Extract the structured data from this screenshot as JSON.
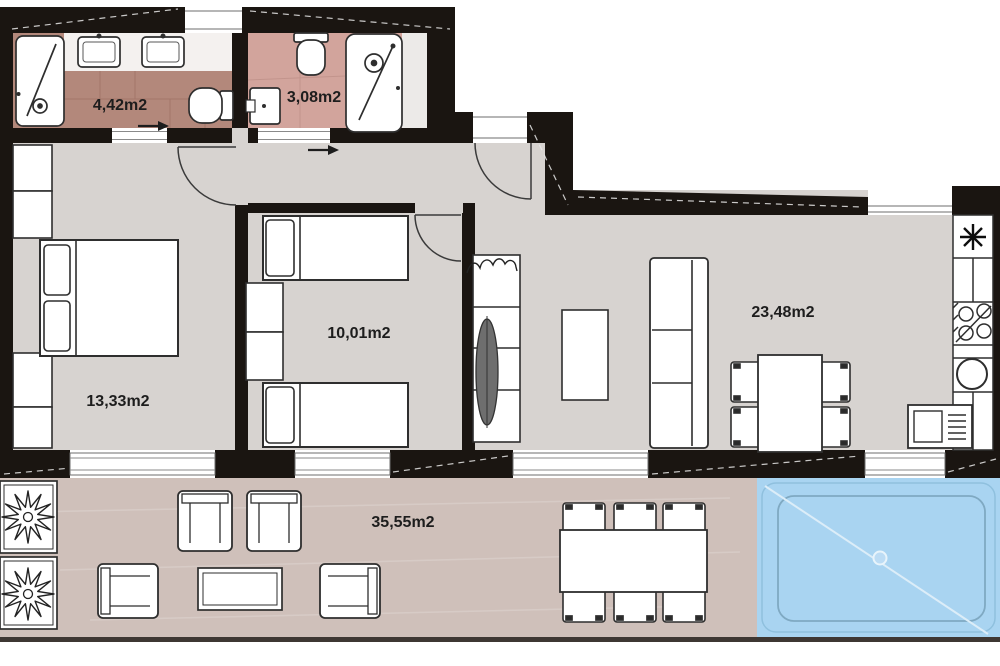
{
  "rooms": {
    "bathroom1": {
      "area": "4,42m2"
    },
    "bathroom2": {
      "area": "3,08m2"
    },
    "bedroom1": {
      "area": "13,33m2"
    },
    "bedroom2": {
      "area": "10,01m2"
    },
    "living_kitchen": {
      "area": "23,48m2"
    },
    "terrace": {
      "area": "35,55m2"
    }
  },
  "colors": {
    "wall": "#1a1511",
    "floor_main": "#d7d3d0",
    "floor_bathroom1": "#b3887b",
    "floor_bathroom2": "#d2a49c",
    "floor_terrace": "#cfc0ba",
    "pool_water": "#a9d4f1",
    "pool_inner_line": "#7fa9c2",
    "pool_diagonal": "#dcedf8",
    "label_text": "#1d1d1d"
  },
  "icons": {
    "heater": "✳",
    "direction_arrow": "→",
    "planter_flower": "✿",
    "shelf_plant": "☘"
  }
}
